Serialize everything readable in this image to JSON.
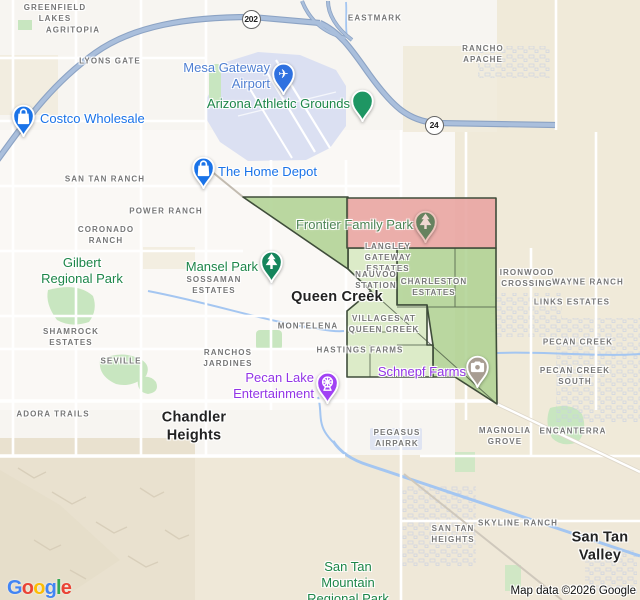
{
  "map": {
    "attribution": "Map data ©2026 Google",
    "logo_letters": [
      {
        "ch": "G",
        "color": "#4285F4"
      },
      {
        "ch": "o",
        "color": "#EA4335"
      },
      {
        "ch": "o",
        "color": "#FBBC05"
      },
      {
        "ch": "g",
        "color": "#4285F4"
      },
      {
        "ch": "l",
        "color": "#34A853"
      },
      {
        "ch": "e",
        "color": "#EA4335"
      }
    ],
    "route_shields": [
      {
        "name": "route-shield-202",
        "label": "202",
        "x": 251,
        "y": 19
      },
      {
        "name": "route-shield-24",
        "label": "24",
        "x": 434,
        "y": 125
      }
    ],
    "colors": {
      "area_label": "#767676",
      "city_label": "#222222",
      "park_label": "#1d8649",
      "store_label": "#1a73e8",
      "airport_label": "#4f7fd2",
      "entertainment_label": "#9334e6",
      "region_red": "#e9a5a2",
      "region_green": "#aed190",
      "region_green_light": "#d6e9c0",
      "region_border": "#3f4d3a",
      "highway_casing": "#8ca3c4",
      "highway": "#aabfdc",
      "water": "#a4c6f1",
      "airport_area": "#dbe0f2",
      "park_area": "#c8e6c0",
      "beige_area": "#f0ead9",
      "mountain_area": "#e9e1cf"
    },
    "labels": [
      {
        "name": "label-greenfield-lakes",
        "kind": "area",
        "anchor": "center",
        "x": 55,
        "y": 14,
        "lines": [
          "GREENFIELD",
          "LAKES"
        ]
      },
      {
        "name": "label-agritopia",
        "kind": "area",
        "anchor": "center",
        "x": 73,
        "y": 31,
        "lines": [
          "AGRITOPIA"
        ]
      },
      {
        "name": "label-lyons-gate",
        "kind": "area",
        "anchor": "center",
        "x": 110,
        "y": 62,
        "lines": [
          "LYONS GATE"
        ]
      },
      {
        "name": "label-eastmark",
        "kind": "area",
        "anchor": "center",
        "x": 375,
        "y": 19,
        "lines": [
          "EASTMARK"
        ]
      },
      {
        "name": "label-rancho-apache",
        "kind": "area",
        "anchor": "center",
        "x": 483,
        "y": 55,
        "lines": [
          "RANCHO",
          "APACHE"
        ]
      },
      {
        "name": "label-san-tan-ranch",
        "kind": "area",
        "anchor": "center",
        "x": 105,
        "y": 180,
        "lines": [
          "SAN TAN RANCH"
        ]
      },
      {
        "name": "label-power-ranch",
        "kind": "area",
        "anchor": "center",
        "x": 166,
        "y": 212,
        "lines": [
          "POWER RANCH"
        ]
      },
      {
        "name": "label-coronado-ranch",
        "kind": "area",
        "anchor": "center",
        "x": 106,
        "y": 236,
        "lines": [
          "CORONADO",
          "RANCH"
        ]
      },
      {
        "name": "label-sossaman-estates",
        "kind": "area",
        "anchor": "center",
        "x": 214,
        "y": 286,
        "lines": [
          "SOSSAMAN",
          "ESTATES"
        ]
      },
      {
        "name": "label-langley-gateway-estates",
        "kind": "area",
        "anchor": "center",
        "x": 388,
        "y": 258,
        "lines": [
          "LANGLEY",
          "GATEWAY",
          "ESTATES"
        ]
      },
      {
        "name": "label-nauvoo-station",
        "kind": "area",
        "anchor": "center",
        "x": 376,
        "y": 281,
        "lines": [
          "NAUVOO",
          "STATION"
        ]
      },
      {
        "name": "label-charleston-estates",
        "kind": "area",
        "anchor": "center",
        "x": 434,
        "y": 288,
        "lines": [
          "CHARLESTON",
          "ESTATES"
        ]
      },
      {
        "name": "label-ironwood-crossing",
        "kind": "area",
        "anchor": "center",
        "x": 527,
        "y": 279,
        "lines": [
          "IRONWOOD",
          "CROSSING"
        ]
      },
      {
        "name": "label-wayne-ranch",
        "kind": "area",
        "anchor": "center",
        "x": 588,
        "y": 283,
        "lines": [
          "WAYNE RANCH"
        ]
      },
      {
        "name": "label-links-estates",
        "kind": "area",
        "anchor": "center",
        "x": 572,
        "y": 303,
        "lines": [
          "LINKS ESTATES"
        ]
      },
      {
        "name": "label-shamrock-estates",
        "kind": "area",
        "anchor": "center",
        "x": 71,
        "y": 338,
        "lines": [
          "SHAMROCK",
          "ESTATES"
        ]
      },
      {
        "name": "label-montelena",
        "kind": "area",
        "anchor": "center",
        "x": 308,
        "y": 327,
        "lines": [
          "MONTELENA"
        ]
      },
      {
        "name": "label-villages-at-queen-creek",
        "kind": "area",
        "anchor": "center",
        "x": 384,
        "y": 325,
        "lines": [
          "VILLAGES AT",
          "QUEEN CREEK"
        ]
      },
      {
        "name": "label-hastings-farms",
        "kind": "area",
        "anchor": "center",
        "x": 360,
        "y": 351,
        "lines": [
          "HASTINGS FARMS"
        ]
      },
      {
        "name": "label-pecan-creek",
        "kind": "area",
        "anchor": "center",
        "x": 578,
        "y": 343,
        "lines": [
          "PECAN CREEK"
        ]
      },
      {
        "name": "label-seville",
        "kind": "area",
        "anchor": "center",
        "x": 121,
        "y": 362,
        "lines": [
          "SEVILLE"
        ]
      },
      {
        "name": "label-ranchos-jardines",
        "kind": "area",
        "anchor": "center",
        "x": 228,
        "y": 359,
        "lines": [
          "RANCHOS",
          "JARDINES"
        ]
      },
      {
        "name": "label-pecan-creek-south",
        "kind": "area",
        "anchor": "center",
        "x": 575,
        "y": 377,
        "lines": [
          "PECAN CREEK",
          "SOUTH"
        ]
      },
      {
        "name": "label-adora-trails",
        "kind": "area",
        "anchor": "center",
        "x": 53,
        "y": 415,
        "lines": [
          "ADORA TRAILS"
        ]
      },
      {
        "name": "label-magnolia-grove",
        "kind": "area",
        "anchor": "center",
        "x": 505,
        "y": 437,
        "lines": [
          "MAGNOLIA",
          "GROVE"
        ]
      },
      {
        "name": "label-encanterra",
        "kind": "area",
        "anchor": "center",
        "x": 573,
        "y": 432,
        "lines": [
          "ENCANTERRA"
        ]
      },
      {
        "name": "label-pegasus-airpark",
        "kind": "area",
        "anchor": "center",
        "x": 397,
        "y": 439,
        "lines": [
          "PEGASUS",
          "AIRPARK"
        ]
      },
      {
        "name": "label-san-tan-heights",
        "kind": "area",
        "anchor": "center",
        "x": 453,
        "y": 535,
        "lines": [
          "SAN TAN",
          "HEIGHTS"
        ]
      },
      {
        "name": "label-skyline-ranch",
        "kind": "area",
        "anchor": "center",
        "x": 518,
        "y": 524,
        "lines": [
          "SKYLINE RANCH"
        ]
      },
      {
        "name": "label-queen-creek-city",
        "kind": "city",
        "anchor": "center",
        "x": 337,
        "y": 298,
        "lines": [
          "Queen Creek"
        ]
      },
      {
        "name": "label-chandler-heights-city",
        "kind": "city",
        "anchor": "center",
        "x": 194,
        "y": 427,
        "lines": [
          "Chandler",
          "Heights"
        ]
      },
      {
        "name": "label-san-tan-valley-city",
        "kind": "city",
        "anchor": "center",
        "x": 600,
        "y": 547,
        "lines": [
          "San Tan",
          "Valley"
        ]
      },
      {
        "name": "label-mesa-gateway-airport",
        "kind": "airport",
        "anchor": "right",
        "x": 270,
        "y": 76,
        "lines": [
          "Mesa Gateway",
          "Airport"
        ]
      },
      {
        "name": "label-arizona-athletic-grounds",
        "kind": "park",
        "anchor": "right",
        "x": 350,
        "y": 104,
        "lines": [
          "Arizona Athletic Grounds"
        ]
      },
      {
        "name": "label-costco-wholesale",
        "kind": "store",
        "anchor": "left",
        "x": 40,
        "y": 119,
        "lines": [
          "Costco Wholesale"
        ]
      },
      {
        "name": "label-the-home-depot",
        "kind": "store",
        "anchor": "left",
        "x": 218,
        "y": 172,
        "lines": [
          "The Home Depot"
        ]
      },
      {
        "name": "label-frontier-family-park",
        "kind": "park",
        "anchor": "right",
        "x": 413,
        "y": 225,
        "color": "#4e8455",
        "lines": [
          "Frontier Family Park"
        ]
      },
      {
        "name": "label-gilbert-regional-park",
        "kind": "park",
        "anchor": "center",
        "x": 82,
        "y": 271,
        "lines": [
          "Gilbert",
          "Regional Park"
        ]
      },
      {
        "name": "label-mansel-park",
        "kind": "park",
        "anchor": "right",
        "x": 258,
        "y": 267,
        "lines": [
          "Mansel Park"
        ]
      },
      {
        "name": "label-pecan-lake-entertainment",
        "kind": "entertainment",
        "anchor": "right",
        "x": 314,
        "y": 386,
        "lines": [
          "Pecan Lake",
          "Entertainment"
        ]
      },
      {
        "name": "label-schnepf-farms",
        "kind": "entertainment",
        "anchor": "right",
        "x": 466,
        "y": 372,
        "lines": [
          "Schnepf Farms"
        ]
      },
      {
        "name": "label-san-tan-mountain-regional-park",
        "kind": "park",
        "anchor": "center",
        "x": 348,
        "y": 583,
        "lines": [
          "San Tan",
          "Mountain",
          "Regional Park"
        ]
      }
    ],
    "markers": [
      {
        "name": "costco-marker",
        "icon": "shopping-bag-icon",
        "x": 23,
        "y": 117,
        "color": "#1a73e8"
      },
      {
        "name": "home-depot-marker",
        "icon": "shopping-bag-icon",
        "x": 203,
        "y": 169,
        "color": "#1a73e8"
      },
      {
        "name": "mesa-gateway-airport-marker",
        "icon": "airplane-icon",
        "x": 283,
        "y": 75,
        "color": "#2f71e0"
      },
      {
        "name": "arizona-athletic-grounds-marker",
        "icon": "dot-icon",
        "x": 362,
        "y": 102,
        "color": "#1e9663"
      },
      {
        "name": "mansel-park-marker",
        "icon": "tree-icon",
        "x": 271,
        "y": 263,
        "color": "#15855c"
      },
      {
        "name": "frontier-family-park-marker",
        "icon": "tree-icon",
        "x": 425,
        "y": 223,
        "color": "#66825f",
        "ring": "#eec4bd",
        "glyph": "#efd8d2"
      },
      {
        "name": "pecan-lake-entertainment-marker",
        "icon": "ferris-wheel-icon",
        "x": 327,
        "y": 384,
        "color": "#a142f4"
      },
      {
        "name": "schnepf-farms-marker",
        "icon": "camera-icon",
        "x": 477,
        "y": 368,
        "color": "#a89d92"
      }
    ]
  }
}
